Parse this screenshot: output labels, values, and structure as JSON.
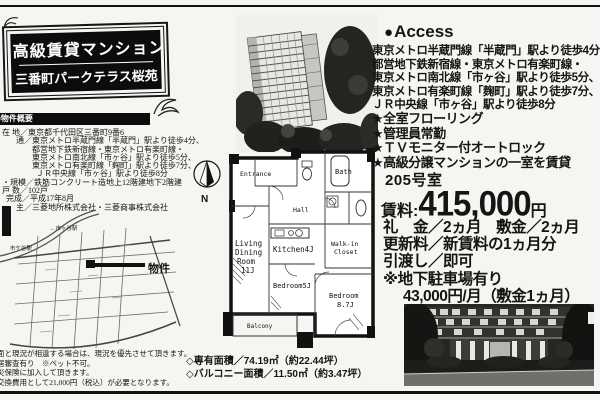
{
  "title_box": {
    "line1": "高級賃貸マンション",
    "line2": "三番町パークテラス桜苑"
  },
  "overview": {
    "header": "■物件概要",
    "lines": [
      "在 地／東京都千代田区三番町9番6",
      "通／東京メトロ半蔵門線「半蔵門」駅より徒歩4分、",
      "都営地下鉄新宿線・東京メトロ有楽町線・",
      "東京メトロ南北線「市ヶ谷」駅より徒歩5分、",
      "東京メトロ有楽町線「麹町」駅より徒歩7分、",
      "ＪＲ中央線「市ヶ谷」駅より徒歩8分",
      "・規模／鉄筋コンクリート造地上12階建地下2階建",
      "戸 数／102戸",
      "完成／平成17年8月",
      "主／三菱地所株式会社・三菱商事株式会社"
    ]
  },
  "map": {
    "station_top": "←市ヶ谷駅",
    "station_left": "市ケ谷駅",
    "property_label": "物件"
  },
  "disclaimer": {
    "lines": [
      "面と現況が相違する場合は、現況を優先させて頂きます。",
      "居審査有り　※ペット不可。",
      "災保険に加入して頂きます。",
      "交換費用として21,000円（税込）が必要となります。"
    ]
  },
  "floor_plan": {
    "compass": "N",
    "rooms": {
      "entrance": "Entrance",
      "bath": "Bath",
      "hall": "Hall",
      "kitchen": "Kitchen4J",
      "living_l1": "Living",
      "living_l2": "Dining",
      "living_l3": "Room",
      "living_l4": "11J",
      "bedroom5": "Bedroom5J",
      "bedroom87_l1": "Bedroom",
      "bedroom87_l2": "8.7J",
      "wic_l1": "Walk-in",
      "wic_l2": "Closet",
      "balcony": "Balcony"
    },
    "area_line1": "◇専有面積／74.19㎡（約22.44坪）",
    "area_line2": "◇バルコニー面積／11.50㎡（約3.47坪）"
  },
  "access": {
    "header": "Access",
    "lines": [
      "東京メトロ半蔵門線「半蔵門」駅より徒歩4分、",
      "都営地下鉄新宿線・東京メトロ有楽町線・",
      "東京メトロ南北線「市ヶ谷」駅より徒歩5分、",
      "東京メトロ有楽町線「麹町」駅より徒歩7分、",
      "ＪＲ中央線「市ヶ谷」駅より徒歩8分"
    ]
  },
  "features": {
    "items": [
      "★全室フローリング",
      "★管理員常勤",
      "★ＴＶモニター付オートロック",
      "★高級分譲マンションの一室を賃貸"
    ]
  },
  "offer": {
    "room_no": "205号室",
    "rent_label": "賃料:",
    "rent_value": "415,000",
    "rent_unit": "円",
    "terms": [
      "礼　金／2ヵ月　敷金／2ヵ月",
      "更新料／新賃料の1ヵ月分",
      "引渡し／即可",
      "※地下駐車場有り",
      "43,000円/月（敷金1ヵ月）"
    ]
  },
  "colors": {
    "ink": "#111111",
    "paper": "#f6f5f1"
  }
}
